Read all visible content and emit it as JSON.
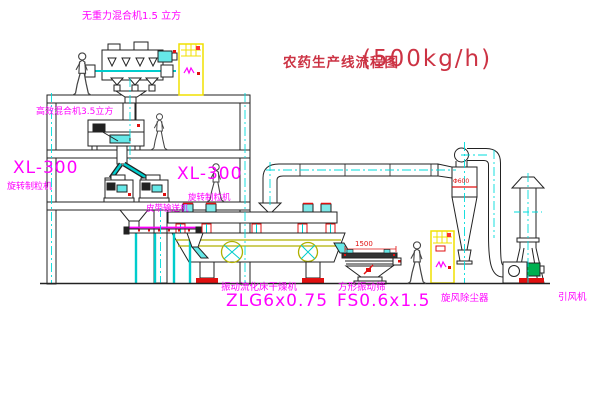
{
  "title": {
    "name": "农药生产线流程图",
    "capacity": "(500kg/h)"
  },
  "labels": {
    "top_mixer": "无重力混合机1.5 立方",
    "floor2_mixer": "高效混合机3.5立方",
    "granulator_left_model": "XL-300",
    "granulator_left_name": "旋转制粒机",
    "granulator_right_model": "XL-300",
    "granulator_right_name": "旋转制粒机",
    "belt_conveyor": "皮带输送机",
    "dryer_name": "振动流化床干燥机",
    "dryer_model": "ZLG6x0.75",
    "sieve_name": "方形振动筛",
    "sieve_model": "FS0.6x1.5",
    "cyclone": "旋风除尘器",
    "induced_draft_fan": "引风机"
  },
  "dimensions": {
    "sieve_length": "1500",
    "cyclone_spec": "Φ600"
  },
  "colors": {
    "label_magenta": "#ff00ff",
    "title_red": "#cc3344",
    "dimension_red": "#e01010",
    "centerline_cyan": "#00dcdc",
    "cabinet_yellow": "#f0e000",
    "dryer_olive": "#b0b000",
    "motor_green": "#00b050",
    "line_black": "#222222"
  }
}
